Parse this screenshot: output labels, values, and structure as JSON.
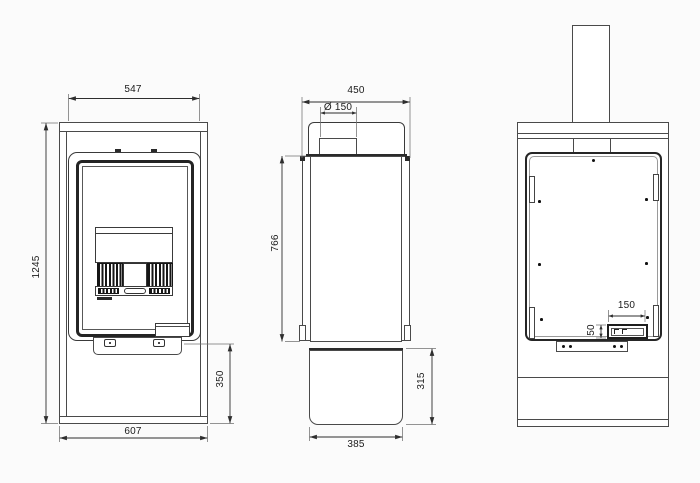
{
  "drawing": {
    "type": "technical-3-view-stove-drawing",
    "line_color": "#4a4a4a",
    "dim_color": "#2e2e2e",
    "dimensions": {
      "front_top_width": "547",
      "front_total_height": "1245",
      "front_plinth_height": "350",
      "front_base_width": "607",
      "side_total_depth": "450",
      "flue_diameter": "Ø 150",
      "side_body_height": "766",
      "side_plinth_height": "315",
      "side_plinth_depth": "385",
      "rear_outlet_width": "150",
      "rear_outlet_height": "50"
    }
  }
}
